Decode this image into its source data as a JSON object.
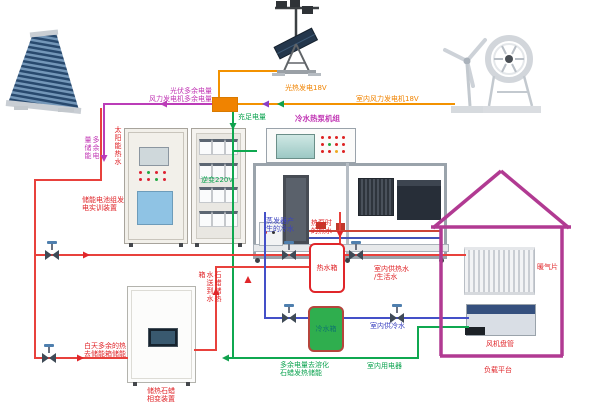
{
  "labels": {
    "solar_hot_water": "太阳能热水",
    "pv_excess_line1": "光伏多余电量",
    "pv_excess_line2": "风力发电机多余电量",
    "excess_storage_vertical": "多余电量储能",
    "battery_device_line1": "储能电池组发",
    "battery_device_line2": "电实训装置",
    "inverter_output": "逆变220V",
    "sufficient_power": "充足电量",
    "pv_generation": "光热发电18V",
    "wind_generation": "室内风力发电机18V",
    "heat_pump_title": "冷水热泵机组",
    "evaporator_cold_line1": "蒸发器产",
    "evaporator_cold_line2": "生的冷水",
    "heat_pump_hot_line1": "热泵时",
    "heat_pump_hot_line2": "的热水",
    "hot_tank": "热水箱",
    "cold_tank": "冷水箱",
    "paraffin_riser_vertical": "石蜡储热水送到水箱",
    "excess_melt_line1": "多余电量去溶化",
    "excess_melt_line2": "石蜡发热储能",
    "day_excess_line1": "白天多余的热",
    "day_excess_line2": "去储能箱储能",
    "paraffin_device_line1": "储热石蜡",
    "paraffin_device_line2": "相变装置",
    "indoor_hot_line1": "室内供热水",
    "indoor_hot_line2": "/生活水",
    "indoor_cold_water": "室内供冷水",
    "indoor_appliances": "室内用电器",
    "radiator": "暖气片",
    "fan_coil": "风机盘管",
    "load_platform": "负载平台"
  },
  "colors": {
    "pipe_hot_water": "#e8413c",
    "pipe_cold_water": "#4450c8",
    "pipe_power_220v": "#0fa850",
    "pipe_power_dc": "#f39200",
    "pipe_excess_power": "#bb3cb8",
    "house_outline": "#b13a92",
    "cold_tank_fill": "#2fae4e",
    "junction_fill": "#f08300"
  }
}
